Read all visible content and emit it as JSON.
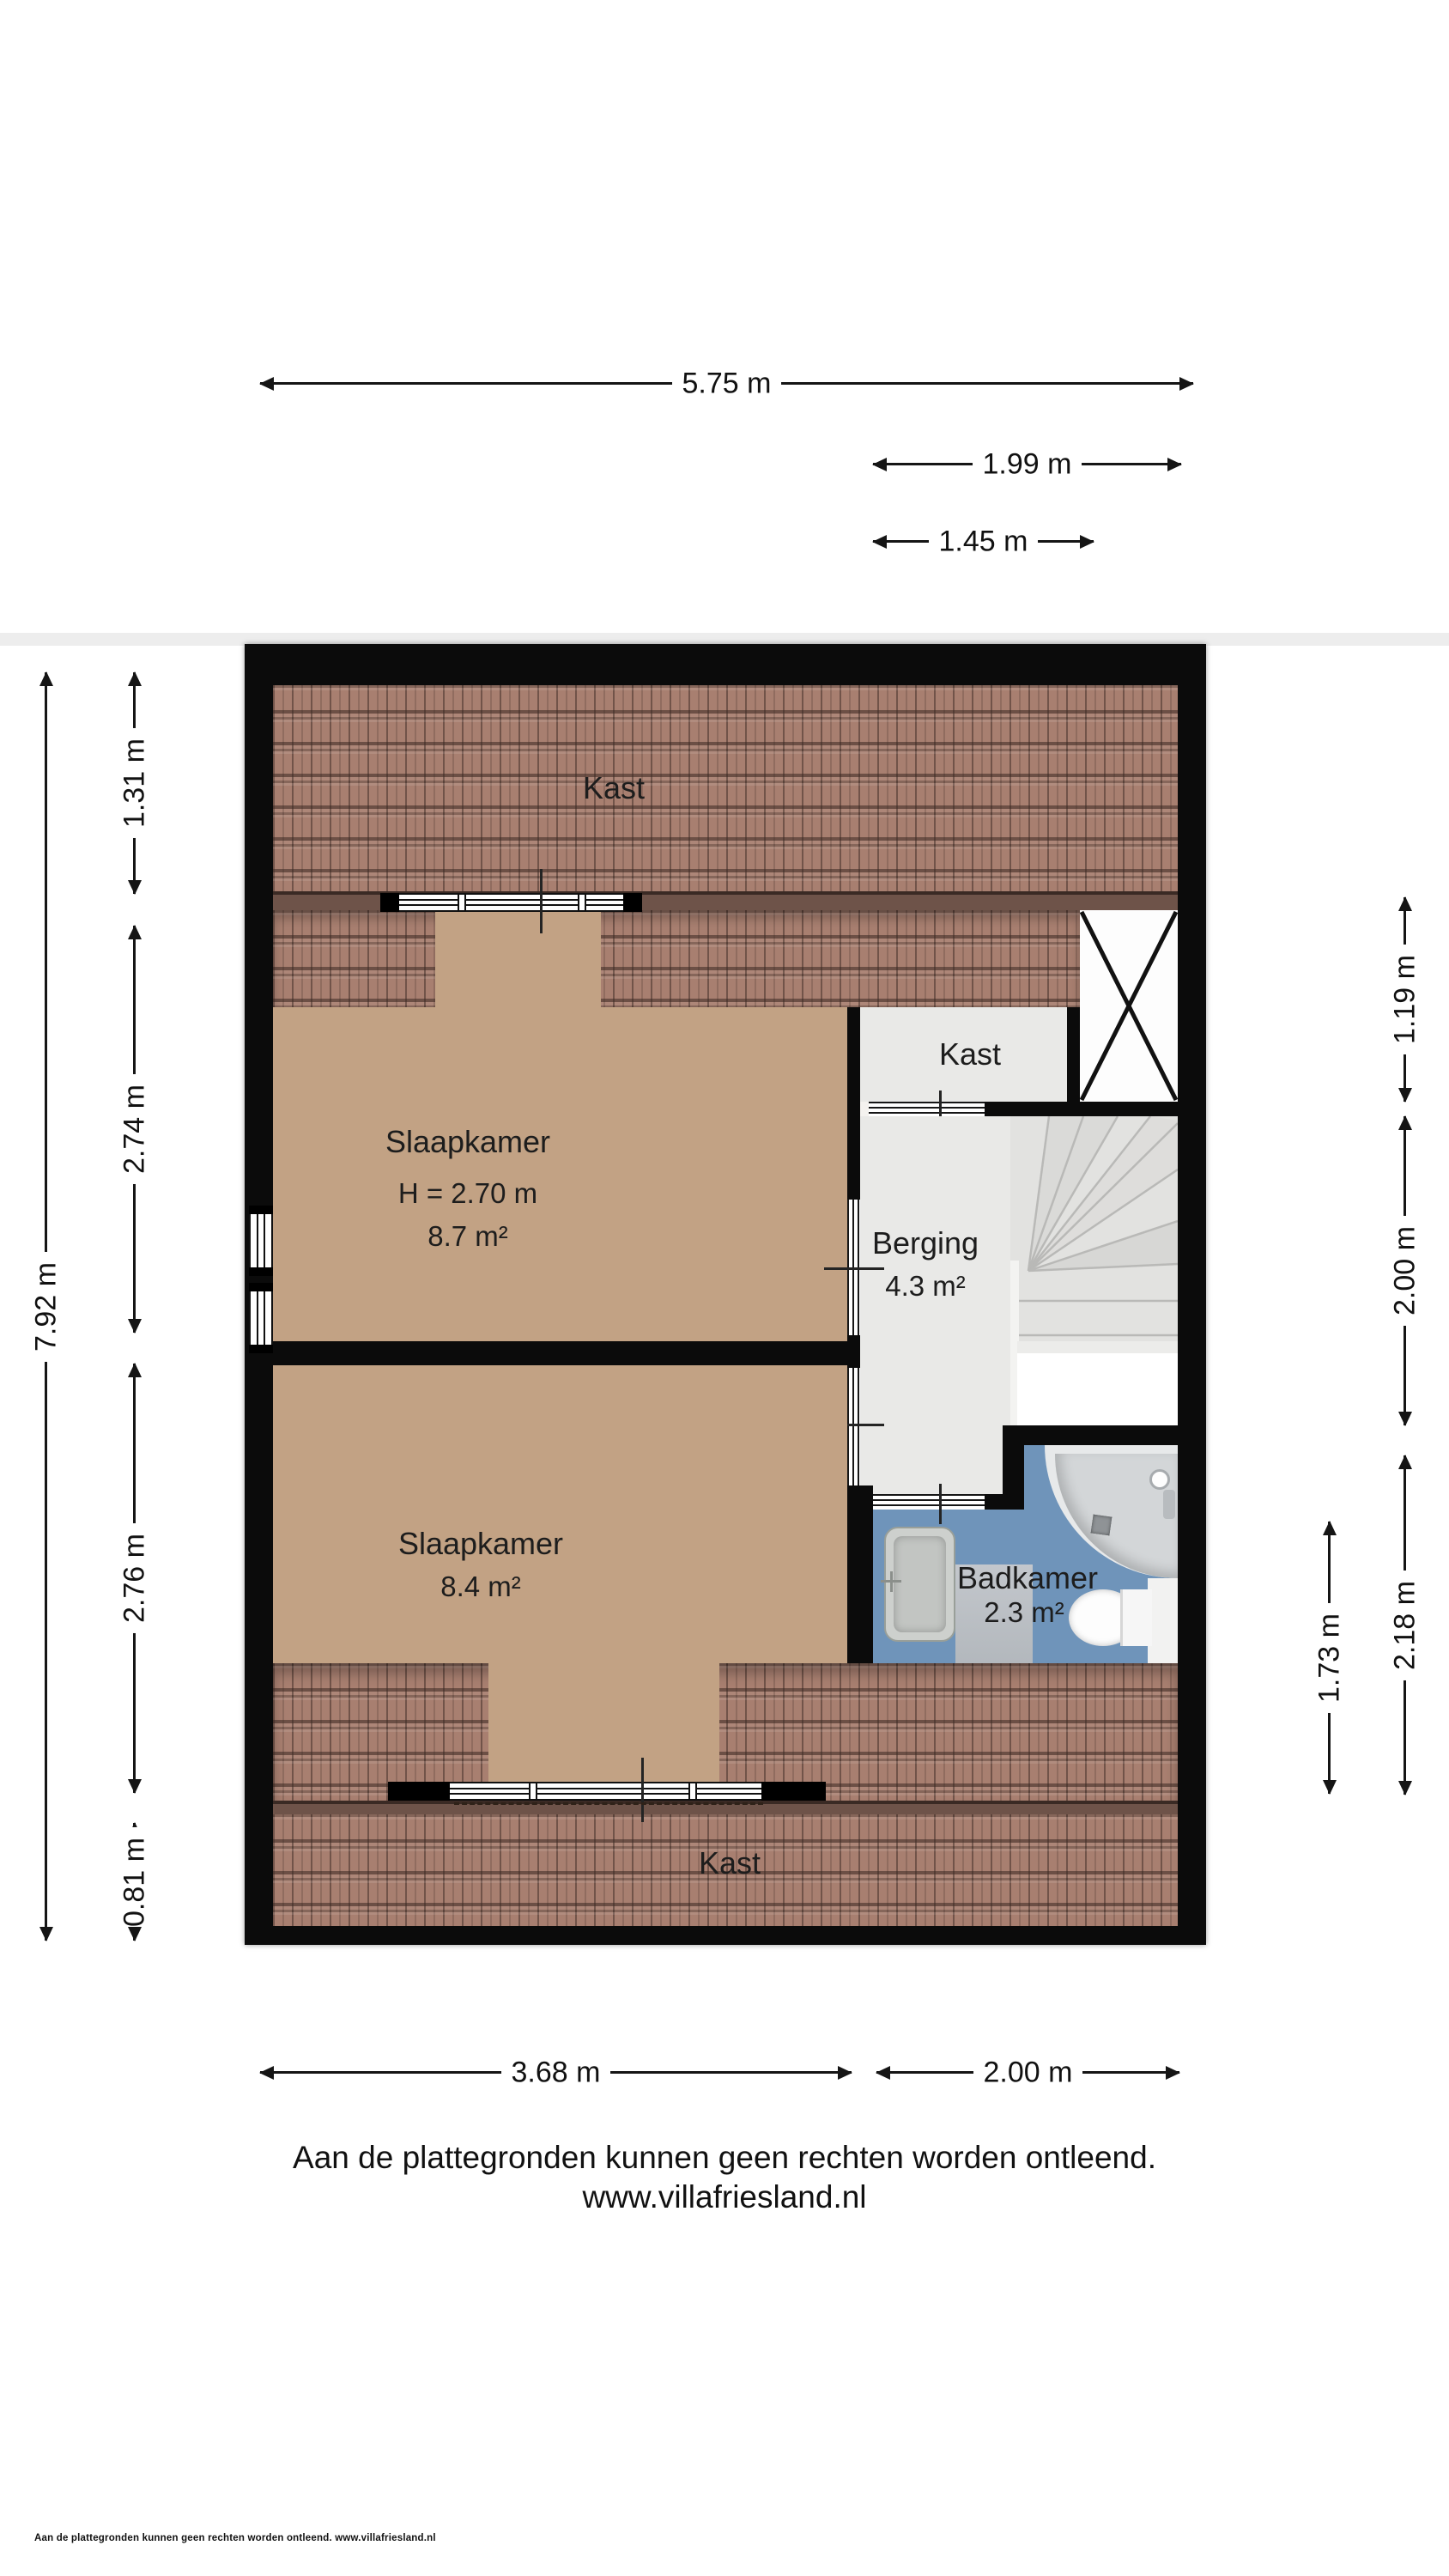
{
  "plan": {
    "rooms": {
      "kast_top": {
        "label": "Kast"
      },
      "slaapkamer1": {
        "label": "Slaapkamer",
        "height_note": "H = 2.70 m",
        "area": "8.7 m²"
      },
      "kast_small": {
        "label": "Kast"
      },
      "berging": {
        "label": "Berging",
        "area": "4.3 m²"
      },
      "slaapkamer2": {
        "label": "Slaapkamer",
        "area": "8.4 m²"
      },
      "badkamer": {
        "label": "Badkamer",
        "area": "2.3 m²"
      },
      "kast_bottom": {
        "label": "Kast"
      }
    },
    "fixtures": [
      "shower",
      "washbasin",
      "toilet",
      "winder-stairs",
      "void-x"
    ],
    "dimensions": {
      "top": [
        {
          "value": "5.75 m"
        },
        {
          "value": "1.99 m"
        },
        {
          "value": "1.45 m"
        }
      ],
      "left": [
        {
          "value": "7.92 m"
        },
        {
          "value": "1.31 m"
        },
        {
          "value": "2.74 m"
        },
        {
          "value": "2.76 m"
        },
        {
          "value": "0.81 m"
        }
      ],
      "right": [
        {
          "value": "1.19 m"
        },
        {
          "value": "2.00 m"
        },
        {
          "value": "2.18 m"
        },
        {
          "value": "1.73 m"
        }
      ],
      "bottom": [
        {
          "value": "3.68 m"
        },
        {
          "value": "2.00 m"
        }
      ]
    },
    "colors": {
      "wall": "#0b0b0b",
      "roof_tile": "#a87f70",
      "roof_eave": "#6e5349",
      "floor_tan": "#c2a284",
      "floor_gray": "#e9e9e7",
      "stairs_gray": "#e2e2e0",
      "bath_blue": "#6f94ba"
    }
  },
  "footer": {
    "disclaimer": "Aan de plattegronden kunnen geen rechten worden ontleend.",
    "website": "www.villafriesland.nl",
    "small_print": "Aan de plattegronden kunnen geen rechten worden ontleend. www.villafriesland.nl"
  }
}
